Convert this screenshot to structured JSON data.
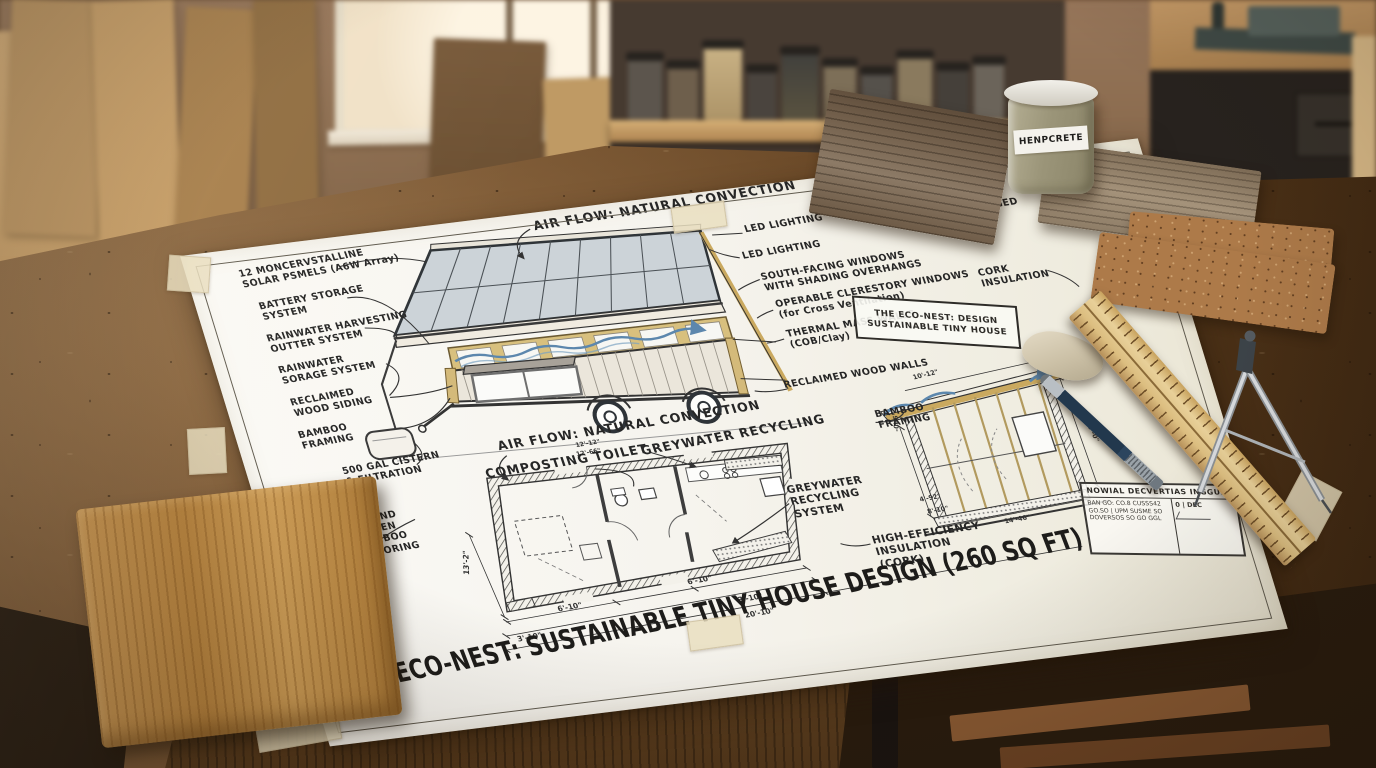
{
  "scene": {
    "setting": "architectural blueprint on woodworking bench",
    "jar_label": "HENPCRETE"
  },
  "sheet": {
    "main_title": "THE ECO-NEST: SUSTAINABLE TINY HOUSE DESIGN (260 SQ FT)",
    "stamp": {
      "line1": "THE ECO-NEST: DESIGN",
      "line2": "SUSTAINABLE TINY HOUSE"
    },
    "labels": {
      "airflow_top": "AIR FLOW: NATURAL CONVECTION",
      "solar": "12 MONCERVSTALLINE\nSOLAR PSMELS (A6W Array)",
      "battery": "BATTERY STORAGE\nSYSTEM",
      "rain_gutter": "RAINWATER HARVESTING\nOUTTER SYSTEM",
      "rain_storage": "RAINWATER\nSORAGE SYSTEM",
      "siding": "RECLAIMED\nWOOD SIDING",
      "bamboo_left": "BAMBOO\nFRAMING",
      "cistern": "500 GAL CISTERN\n& FILTRATION",
      "bamboo_floor": "STRAND\nWOVEN\nBAMBOO\nFLOORING",
      "led1": "LED LIGHTING",
      "led2": "LED LIGHTING",
      "south_windows": "SOUTH-FACING WINDOWS\nWITH SHADING OVERHANGS",
      "clerestory": "OPERABLE CLERESTORY WINDOWS\n(for Cross Ventilation)",
      "thermal": "THERMAL MASS WALLS\n(COB/Clay)",
      "barn_wood": "RECLAIMED AGED\nBARN WOOD",
      "cork": "CORK\nINSULATION",
      "wood_walls": "RECLAIMED WOOD WALLS",
      "bamboo_right": "BAMBOO\nFRAMING",
      "airflow_plan": "AIR FLOW: NATURAL CONVECTION",
      "composting": "COMPOSTING TOILET",
      "greywater": "GREYWATER RECYCLING",
      "greywater_system": "GREYWATER\nRECYCLING\nSYSTEM",
      "insulation": "HIGH-EFFICIENCY\nINSULATION\n(CORK)"
    },
    "dims": {
      "plan_w1": "6'-10\"",
      "plan_w2": "3'-10\"",
      "plan_w3": "6'-10\"",
      "plan_w4": "3'-10\"",
      "plan_total": "20'-10\"",
      "plan_h": "13'-2\"",
      "air1": "12'-12\"",
      "air2": "12'-66\"",
      "sect_top": "10'-12\"",
      "sect_right": "20'-0\"",
      "sect_bottom": "14'-46\"",
      "sect_left": "-0'-6\"",
      "ins_a": "4'-92\"",
      "ins_b": "8'-10\""
    },
    "title_block": {
      "heading": "NOWIAL DECVERTIAS INGGUE",
      "note1": "BAN GO: CO.8 CUSSS42",
      "note2": "GO.SO | UPM SUSME SO",
      "note3": "DOVERSOS SO GO GGL",
      "scale": "0 | DEC"
    }
  },
  "palette": {
    "paper": "#f6f4ee",
    "ink": "#2e2c28",
    "framing_tan": "#d8c07e",
    "solar_grey": "#ccd3d8",
    "airflow_blue": "#5c87ad",
    "bench_wood": "#64432 3",
    "bamboo_sample": "#c08d47",
    "cork_sample": "#ad7a49",
    "barnwood_grey": "#7c6a56"
  }
}
